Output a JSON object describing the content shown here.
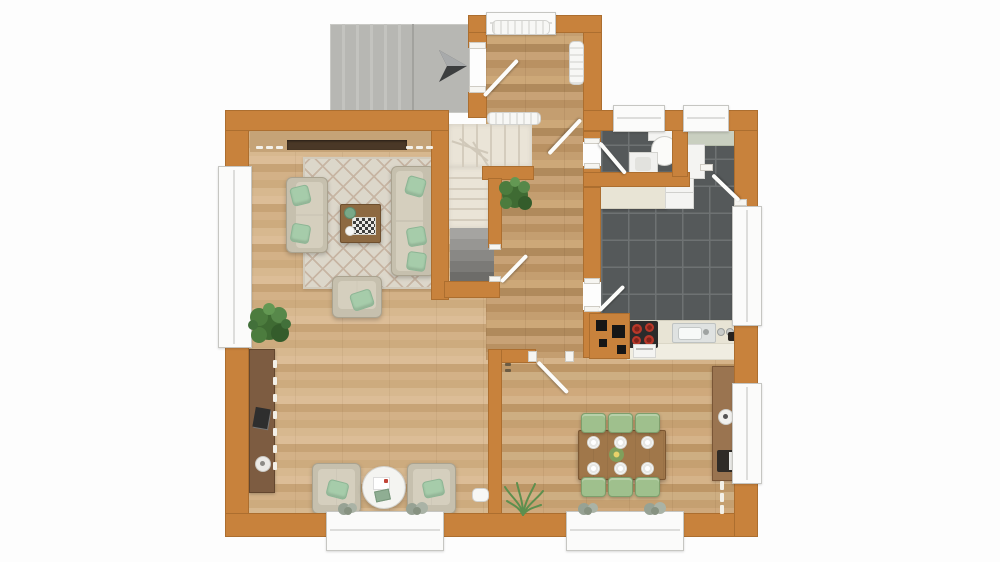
{
  "scene": {
    "kind": "3d-rendered floor plan, top-down view, ground floor",
    "rooms": [
      "entrance-porch",
      "entry-hall",
      "staircase",
      "living-room",
      "bathroom",
      "kitchen",
      "dining-area"
    ],
    "objects": [
      "entrance-arrow",
      "radiator",
      "staircase-up",
      "staircase-down",
      "sofa",
      "sofa",
      "armchair",
      "coffee-table",
      "chessboard",
      "rug",
      "tv-sideboard",
      "desk",
      "laptop",
      "lounge-chair",
      "lounge-chair",
      "round-side-table",
      "potted-plant",
      "potted-plant",
      "grass-plant",
      "windowsill-plants",
      "dining-table",
      "dining-chairs",
      "plates",
      "centerpiece",
      "sideboard",
      "coffee-machine",
      "kitchen-counter",
      "fridge",
      "stove",
      "oven",
      "kitchen-sink",
      "chimney-block",
      "toilet",
      "bathroom-sink",
      "windows",
      "door-swings"
    ]
  },
  "palette": {
    "wall": "#c8823c",
    "tile": "#55595a",
    "porch": "#b7b7b3",
    "rug": "#dcd7ca",
    "staircream": "#eae4d7",
    "pillow": "#a6ccaa",
    "chair": "#9fc08d",
    "dtable": "#a0774a",
    "background": "#fdfdfd"
  },
  "counts": {
    "porch_steps": 5,
    "stair_treads_top": 5,
    "stair_treads_side": 5,
    "stair_treads_winder": 3,
    "stair_treads_basement": 5,
    "dining_chairs_top": 3,
    "dining_chairs_bottom": 3,
    "plates": 6,
    "stove_burners": 4
  }
}
